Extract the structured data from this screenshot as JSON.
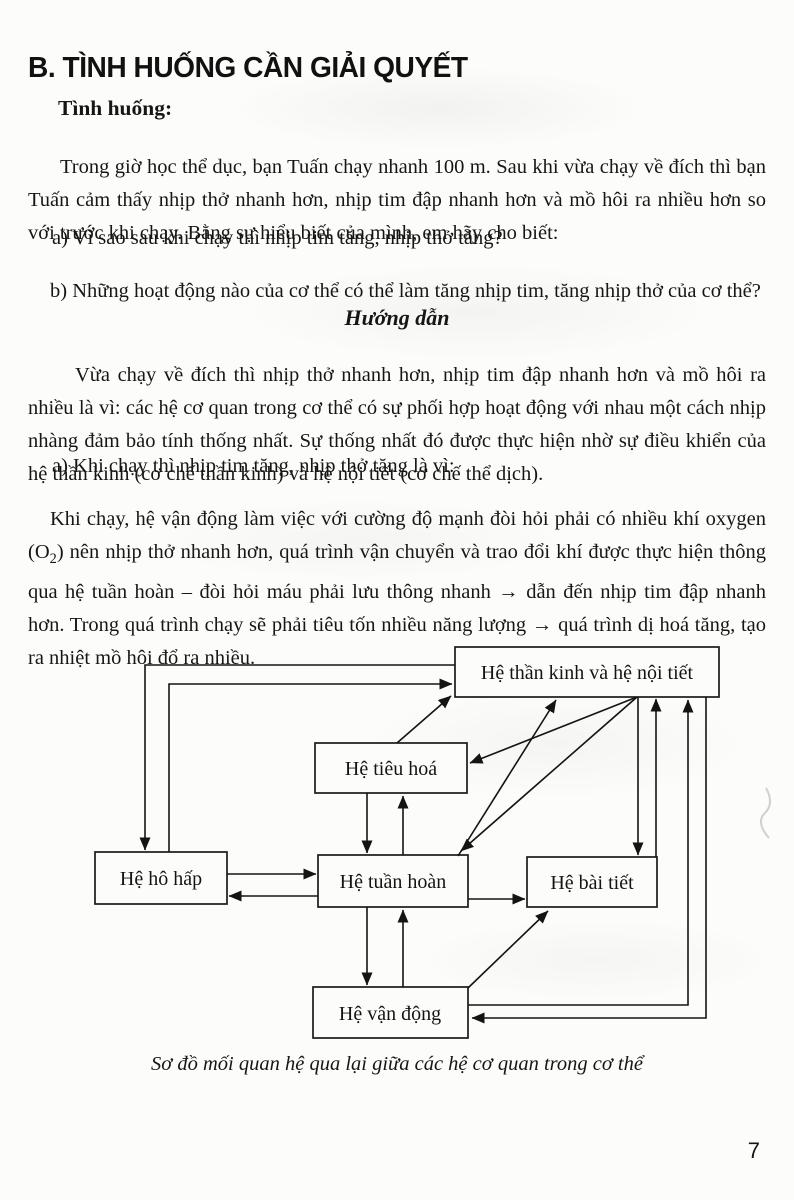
{
  "page": {
    "heading": "B. TÌNH HUỐNG CẦN GIẢI QUYẾT",
    "page_number": "7",
    "ink_color": "#161616",
    "paper_color": "#fcfcfa"
  },
  "situation": {
    "label": "Tình huống:",
    "intro": "Trong giờ học thể dục, bạn Tuấn chạy nhanh 100 m. Sau khi vừa chạy về đích thì bạn Tuấn cảm thấy nhịp thở nhanh hơn, nhịp tim đập nhanh hơn và mồ hôi ra nhiều hơn so với trước khi chạy. Bằng sự hiểu biết của mình, em hãy cho biết:",
    "question_a": "a) Vì sao sau khi chạy thì nhịp tim tăng, nhịp thở tăng?",
    "question_b": "b) Những hoạt động nào của cơ thể có thể làm tăng nhịp tim, tăng nhịp thở của cơ thể?"
  },
  "guide": {
    "title": "Hướng dẫn",
    "para1": "Vừa chạy về đích thì nhịp thở nhanh hơn, nhịp tim đập nhanh hơn và mồ hôi ra nhiều là vì: các hệ cơ quan trong cơ thể có sự phối hợp hoạt động với nhau một cách nhịp nhàng đảm bảo tính thống nhất. Sự thống nhất đó được thực hiện nhờ sự điều khiển của hệ thần kinh (cơ chế thần kinh) và hệ nội tiết (cơ chế thể dịch).",
    "answer_a_heading": "a) Khi chạy thì nhịp tim tăng, nhịp thở tăng là vì:",
    "answer_a_body_1": "Khi chạy, hệ vận động làm việc với cường độ mạnh đòi hỏi phải có nhiều khí oxygen (O",
    "answer_a_sub": "2",
    "answer_a_body_2": ") nên nhịp thở nhanh hơn, quá trình vận chuyển và trao đổi khí được thực hiện thông qua hệ tuần hoàn – đòi hỏi máu phải lưu thông nhanh → dẫn đến nhịp tim đập nhanh hơn. Trong quá trình chạy sẽ phải tiêu tốn nhiều năng lượng → quá trình dị hoá tăng, tạo ra nhiệt mồ hôi đổ ra nhiều."
  },
  "diagram": {
    "caption": "Sơ đồ mối quan hệ qua lại giữa các hệ cơ quan trong cơ thể",
    "boxes": {
      "nervous": "Hệ thần kinh và hệ nội tiết",
      "digestive": "Hệ tiêu hoá",
      "respiratory": "Hệ hô hấp",
      "circulatory": "Hệ tuần hoàn",
      "excretory": "Hệ bài tiết",
      "musculoskeletal": "Hệ vận động"
    },
    "relations": [
      "nervous→respiratory",
      "respiratory→nervous",
      "digestive→nervous",
      "nervous→digestive",
      "circulatory→nervous",
      "nervous→circulatory",
      "nervous→excretory",
      "excretory→nervous",
      "musculoskeletal→nervous",
      "nervous→musculoskeletal",
      "respiratory→circulatory",
      "circulatory→respiratory",
      "circulatory→excretory",
      "digestive→circulatory",
      "circulatory→digestive",
      "circulatory→musculoskeletal",
      "musculoskeletal→circulatory",
      "musculoskeletal→excretory"
    ]
  }
}
